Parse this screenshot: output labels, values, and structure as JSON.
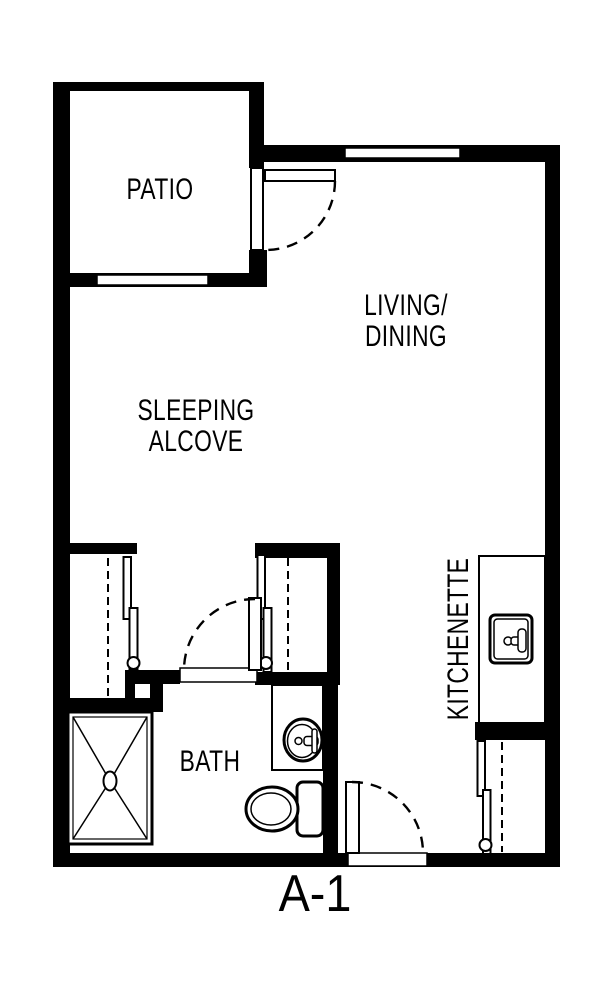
{
  "plan": {
    "name": "A-1",
    "rooms": {
      "patio": {
        "label": "PATIO"
      },
      "living_dining": {
        "line1": "LIVING/",
        "line2": "DINING"
      },
      "sleeping_alcove": {
        "line1": "SLEEPING",
        "line2": "ALCOVE"
      },
      "kitchenette": {
        "label": "KITCHENETTE"
      },
      "bath": {
        "label": "BATH"
      }
    },
    "colors": {
      "walls": "#000000",
      "background": "#ffffff"
    }
  }
}
